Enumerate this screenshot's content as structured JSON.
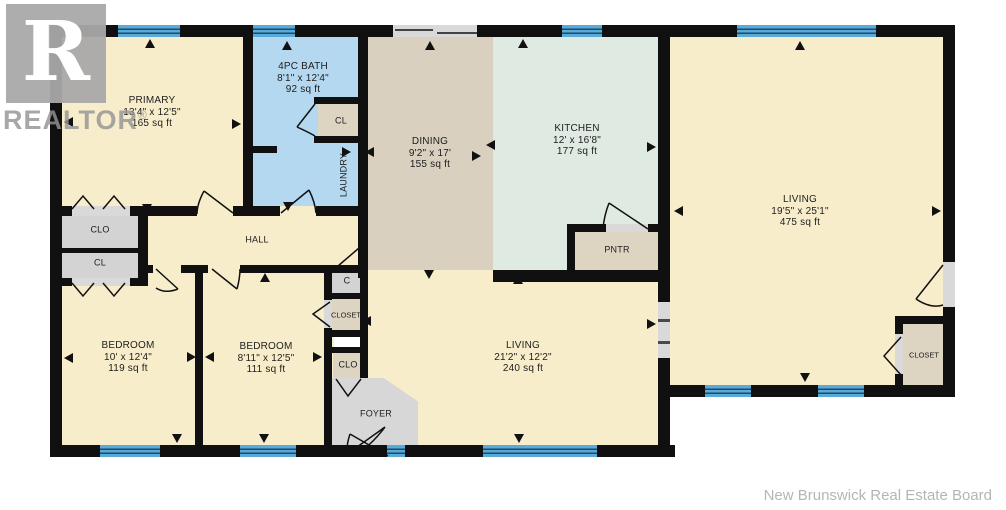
{
  "branding": {
    "logo_letter": "R",
    "logo_text": "REALTOR",
    "logo_reg": "®",
    "credit": "New Brunswick Real Estate Board"
  },
  "rooms": [
    {
      "name": "PRIMARY",
      "dims": "13'4\" x 12'5\"",
      "area": "165 sq ft"
    },
    {
      "name": "4PC BATH",
      "dims": "8'1\" x 12'4\"",
      "area": "92 sq ft"
    },
    {
      "name": "DINING",
      "dims": "9'2\" x 17'",
      "area": "155 sq ft"
    },
    {
      "name": "KITCHEN",
      "dims": "12' x 16'8\"",
      "area": "177 sq ft"
    },
    {
      "name": "LIVING",
      "dims": "19'5\" x 25'1\"",
      "area": "475 sq ft"
    },
    {
      "name": "BEDROOM",
      "dims": "10' x 12'4\"",
      "area": "119 sq ft"
    },
    {
      "name": "BEDROOM",
      "dims": "8'11\" x 12'5\"",
      "area": "111 sq ft"
    },
    {
      "name": "LIVING",
      "dims": "21'2\" x 12'2\"",
      "area": "240 sq ft"
    }
  ],
  "labels": {
    "hall": "HALL",
    "laundry": "LAUNDRY",
    "bath_closet": "CL",
    "clo_left": "CLO",
    "cl_left": "CL",
    "c_small": "C",
    "closet_center": "CLOSET",
    "clo_center": "CLO",
    "foyer": "FOYER",
    "pantry": "PNTR",
    "closet_right": "CLOSET"
  },
  "colors": {
    "wall": "#101010",
    "cream": "#f8edca",
    "bath_blue": "#b5d8f1",
    "dining_tan": "#d9d0c0",
    "kitchen_mint": "#dfeae2",
    "closet_grey": "#d3d3d3",
    "closet_tan": "#ddd4c2",
    "foyer_grey": "#d7d7d7",
    "window_blue": "#59a9d9",
    "window_line": "#1b4c6c",
    "opening_grey": "#d9d9d9"
  }
}
